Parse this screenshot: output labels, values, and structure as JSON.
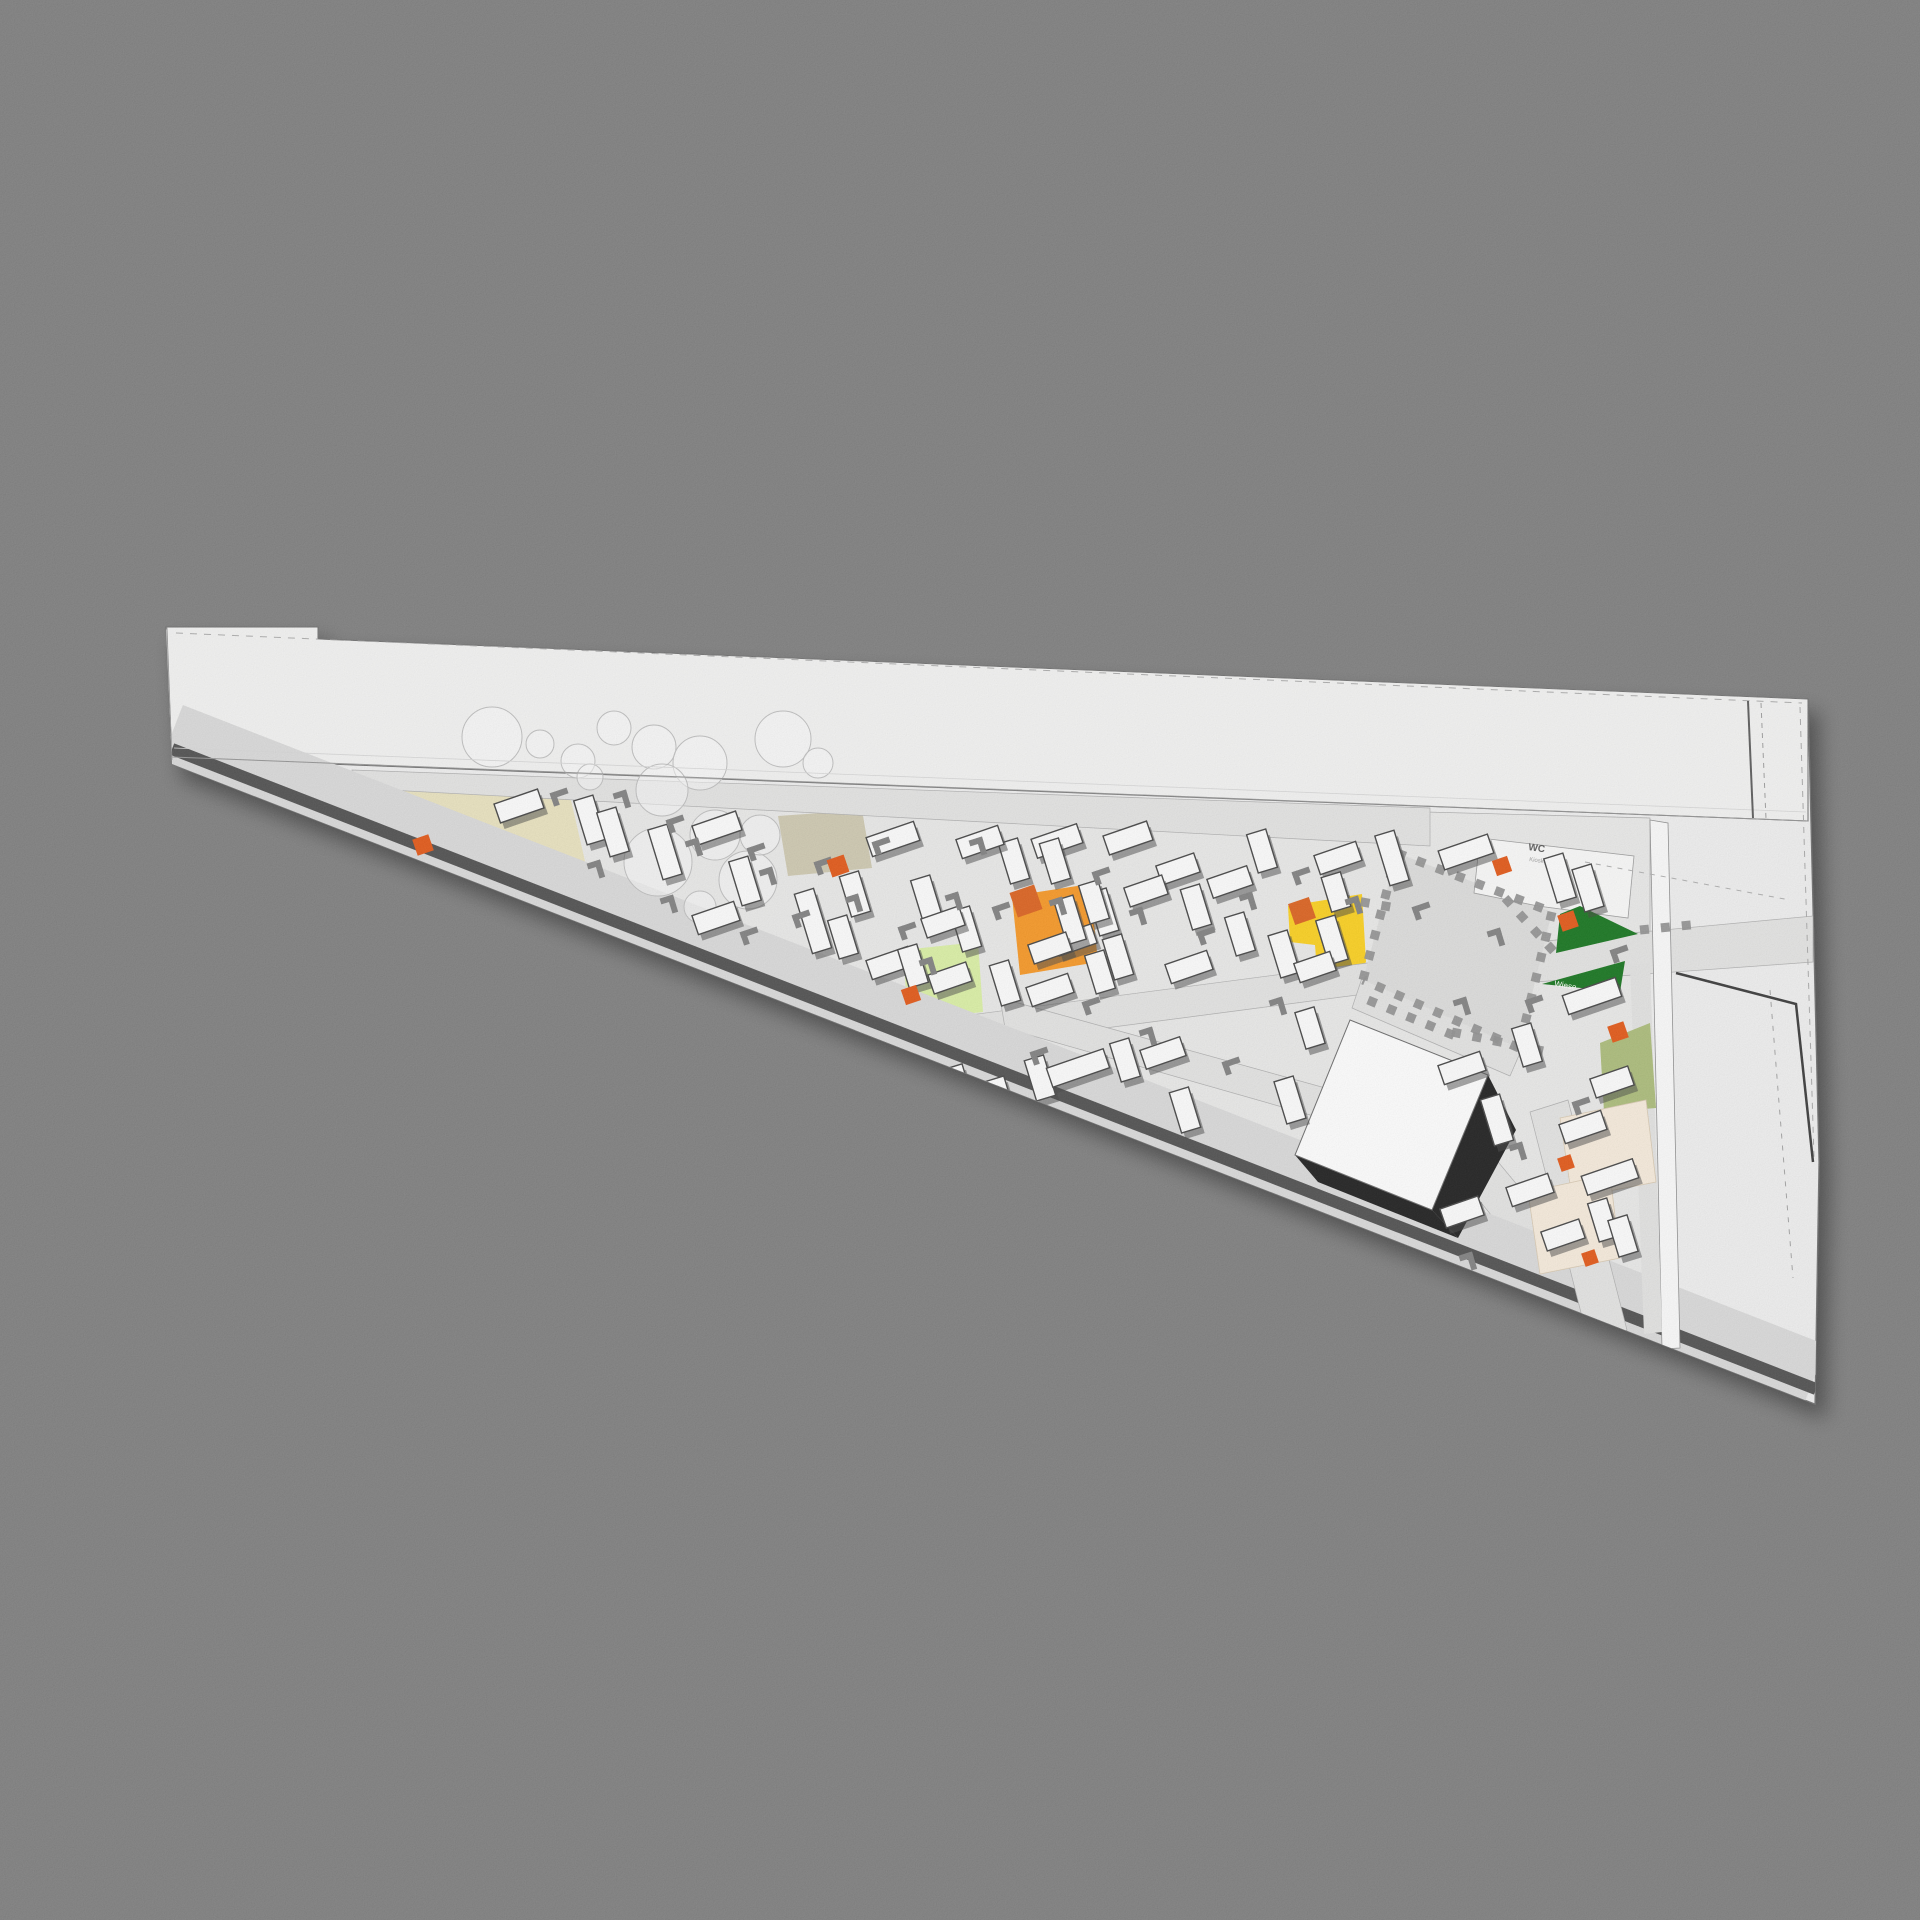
{
  "canvas": {
    "w": 1920,
    "h": 1920,
    "bg": "#7a7a7a"
  },
  "palette": {
    "floor": "#e9e9e8",
    "slab": "#efefef",
    "roof": "#f3f3f2",
    "road": "#e3e3e2",
    "band": "#d9d9d9",
    "stripe": "#4a4a4a",
    "plaza": "#dcdcdb",
    "beige": "#e9e2bd",
    "tan": "#cdc7ae",
    "orange": "#F7941E",
    "orange_dark": "#DB5B16",
    "accent": "#E25110",
    "yellow": "#FCCF14",
    "lightgreen": "#DAF0A2",
    "darkgreen": "#117014",
    "olive": "#A9BA74",
    "cream": "#F7EBDB",
    "white": "#FFFFFF",
    "room": "#fafaf9",
    "table_stroke": "#3d3d3d",
    "bench": "#7c7c7c",
    "tree_stroke": "#bdbdbd",
    "cube_shadow": "#171717",
    "cren": "#8c8c8c",
    "facade": "#fbfbfb",
    "strip2": "#e2e2e1",
    "leftface": "#dedede"
  },
  "labels": {
    "wc": "WC",
    "wc_sub": "Kiosk",
    "meadow": "Wiese"
  },
  "label_meta": {
    "wc": {
      "x": 1528,
      "y": 850,
      "size": 10,
      "rot": 8,
      "fill": "#555555",
      "bold": true
    },
    "wc_sub": {
      "x": 1529,
      "y": 861,
      "size": 6,
      "rot": 8,
      "fill": "#9a9a9a",
      "bold": false
    },
    "meadow": {
      "x": 1554,
      "y": 986,
      "size": 8,
      "rot": 10,
      "fill": "#ffffff",
      "bold": false
    }
  },
  "silhouette": [
    [
      166,
      627
    ],
    [
      318,
      627
    ],
    [
      318,
      639
    ],
    [
      1808,
      699
    ],
    [
      1819,
      1162
    ],
    [
      1815,
      1404
    ],
    [
      172,
      764
    ]
  ],
  "roof": [
    [
      166,
      627
    ],
    [
      318,
      627
    ],
    [
      318,
      639
    ],
    [
      1808,
      699
    ],
    [
      1808,
      821
    ],
    [
      172,
      758
    ]
  ],
  "floor": [
    [
      350,
      783
    ],
    [
      1650,
      818
    ],
    [
      1650,
      1302
    ]
  ],
  "zones": [
    {
      "name": "zone-beige-wedge",
      "fill": "beige",
      "pts": [
        [
          352,
          786
        ],
        [
          570,
          796
        ],
        [
          588,
          874
        ],
        [
          440,
          862
        ]
      ]
    },
    {
      "name": "zone-tan-square",
      "fill": "tan",
      "pts": [
        [
          778,
          816
        ],
        [
          862,
          810
        ],
        [
          872,
          868
        ],
        [
          788,
          876
        ]
      ]
    },
    {
      "name": "zone-orange-square",
      "fill": "orange",
      "pts": [
        [
          1012,
          896
        ],
        [
          1090,
          884
        ],
        [
          1098,
          962
        ],
        [
          1020,
          975
        ]
      ]
    },
    {
      "name": "zone-lightgreen-square",
      "fill": "lightgreen",
      "pts": [
        [
          903,
          950
        ],
        [
          978,
          942
        ],
        [
          983,
          1012
        ],
        [
          908,
          1020
        ]
      ]
    },
    {
      "name": "zone-yellow",
      "fill": "yellow",
      "pts": [
        [
          1288,
          906
        ],
        [
          1362,
          894
        ],
        [
          1366,
          962
        ],
        [
          1342,
          990
        ],
        [
          1318,
          984
        ],
        [
          1315,
          945
        ],
        [
          1290,
          942
        ]
      ]
    }
  ],
  "zones2": [
    {
      "name": "zone-left-face",
      "fill": "leftface",
      "pts": [
        [
          158,
          640
        ],
        [
          167,
          628
        ],
        [
          172,
          760
        ],
        [
          160,
          706
        ]
      ],
      "stroke": "#888888"
    },
    {
      "name": "zone-facade-strip",
      "fill": "facade",
      "pts": [
        [
          1650,
          820
        ],
        [
          1668,
          823
        ],
        [
          1680,
          1348
        ],
        [
          1662,
          1349
        ]
      ],
      "stroke": "#8a8a8a"
    },
    {
      "name": "zone-gray-strip",
      "fill": "strip2",
      "pts": [
        [
          1630,
          965
        ],
        [
          1650,
          962
        ],
        [
          1662,
          1332
        ],
        [
          1644,
          1334
        ]
      ]
    },
    {
      "name": "zone-wc-room",
      "fill": "room",
      "pts": [
        [
          1480,
          838
        ],
        [
          1634,
          856
        ],
        [
          1628,
          918
        ],
        [
          1538,
          906
        ],
        [
          1474,
          893
        ]
      ],
      "stroke": "#999999"
    },
    {
      "name": "zone-green-triangle-1",
      "fill": "darkgreen",
      "pts": [
        [
          1556,
          953
        ],
        [
          1638,
          934
        ],
        [
          1580,
          906
        ],
        [
          1560,
          914
        ]
      ]
    },
    {
      "name": "zone-green-triangle-2",
      "fill": "darkgreen",
      "pts": [
        [
          1542,
          984
        ],
        [
          1625,
          961
        ],
        [
          1620,
          992
        ]
      ]
    },
    {
      "name": "zone-olive-square",
      "fill": "olive",
      "pts": [
        [
          1600,
          1043
        ],
        [
          1650,
          1023
        ],
        [
          1656,
          1108
        ],
        [
          1604,
          1112
        ]
      ]
    },
    {
      "name": "zone-cream-area-1",
      "fill": "cream",
      "pts": [
        [
          1560,
          1118
        ],
        [
          1646,
          1100
        ],
        [
          1656,
          1182
        ],
        [
          1572,
          1198
        ]
      ],
      "stroke": "#d8c8b0"
    },
    {
      "name": "zone-cream-area-2",
      "fill": "cream",
      "pts": [
        [
          1528,
          1192
        ],
        [
          1610,
          1174
        ],
        [
          1620,
          1258
        ],
        [
          1540,
          1274
        ]
      ],
      "stroke": "#d8c8b0"
    }
  ],
  "roads": [
    {
      "name": "road-main",
      "pts": [
        [
          352,
          770
        ],
        [
          1430,
          808
        ],
        [
          1430,
          846
        ],
        [
          352,
          788
        ]
      ]
    },
    {
      "name": "road-cross-up",
      "pts": [
        [
          810,
          1036
        ],
        [
          1375,
          962
        ],
        [
          1380,
          992
        ],
        [
          816,
          1066
        ]
      ]
    },
    {
      "name": "road-cross-down",
      "pts": [
        [
          1000,
          998
        ],
        [
          1470,
          1128
        ],
        [
          1596,
          1280
        ],
        [
          1560,
          1300
        ],
        [
          1440,
          1152
        ],
        [
          1005,
          1028
        ]
      ]
    },
    {
      "name": "road-plaza-south",
      "pts": [
        [
          1362,
          978
        ],
        [
          1523,
          1046
        ],
        [
          1510,
          1076
        ],
        [
          1352,
          1008
        ]
      ]
    },
    {
      "name": "road-east",
      "pts": [
        [
          1535,
          942
        ],
        [
          1813,
          916
        ],
        [
          1813,
          962
        ],
        [
          1535,
          982
        ]
      ]
    }
  ],
  "exit_road": {
    "name": "road-exit",
    "pts": [
      [
        1530,
        1112
      ],
      [
        1568,
        1100
      ],
      [
        1627,
        1330
      ],
      [
        1590,
        1348
      ]
    ]
  },
  "band": {
    "center": [
      [
        172,
        733
      ],
      [
        1816,
        1373
      ]
    ],
    "w": 60,
    "stripe": [
      [
        172,
        749
      ],
      [
        1816,
        1389
      ]
    ],
    "stripe_w": 12
  },
  "plaza": {
    "pts": [
      [
        1397,
        853
      ],
      [
        1552,
        912
      ],
      [
        1519,
        1048
      ],
      [
        1363,
        980
      ]
    ]
  },
  "crenellation": [
    [
      [
        1397,
        853
      ],
      [
        1552,
        912
      ]
    ],
    [
      [
        1552,
        912
      ],
      [
        1519,
        1048
      ]
    ],
    [
      [
        1519,
        1048
      ],
      [
        1363,
        980
      ]
    ],
    [
      [
        1363,
        980
      ],
      [
        1397,
        853
      ]
    ],
    [
      [
        1505,
        898
      ],
      [
        1557,
        955
      ]
    ],
    [
      [
        1340,
        898
      ],
      [
        1396,
        908
      ]
    ],
    [
      [
        1368,
        1000
      ],
      [
        1460,
        1038
      ]
    ],
    [
      [
        1452,
        1032
      ],
      [
        1548,
        1052
      ]
    ],
    [
      [
        1640,
        930
      ],
      [
        1700,
        924
      ]
    ]
  ],
  "cube": {
    "pts": [
      [
        1350,
        1020
      ],
      [
        1488,
        1075
      ],
      [
        1432,
        1210
      ],
      [
        1295,
        1155
      ]
    ],
    "shadow": [
      [
        [
          1488,
          1075
        ],
        [
          1516,
          1130
        ],
        [
          1458,
          1238
        ],
        [
          1432,
          1210
        ]
      ],
      [
        [
          1295,
          1155
        ],
        [
          1432,
          1210
        ],
        [
          1458,
          1238
        ],
        [
          1318,
          1182
        ]
      ]
    ]
  },
  "trees": [
    [
      492,
      737,
      30
    ],
    [
      540,
      744,
      14
    ],
    [
      578,
      761,
      17
    ],
    [
      614,
      728,
      17
    ],
    [
      590,
      777,
      13
    ],
    [
      654,
      747,
      22
    ],
    [
      700,
      763,
      27
    ],
    [
      783,
      739,
      28
    ],
    [
      818,
      763,
      15
    ],
    [
      662,
      790,
      26
    ],
    [
      658,
      862,
      34
    ],
    [
      715,
      835,
      25
    ],
    [
      748,
      880,
      29
    ],
    [
      760,
      835,
      20
    ],
    [
      700,
      907,
      16
    ]
  ],
  "tables": [
    [
      519,
      806,
      -19,
      46
    ],
    [
      590,
      820,
      73,
      46
    ],
    [
      613,
      832,
      73,
      46
    ],
    [
      665,
      852,
      73,
      52
    ],
    [
      717,
      828,
      -19,
      46
    ],
    [
      745,
      881,
      73,
      46
    ],
    [
      716,
      918,
      -19,
      44
    ],
    [
      893,
      839,
      -19,
      50
    ],
    [
      855,
      894,
      73,
      42
    ],
    [
      813,
      921,
      73,
      62
    ],
    [
      843,
      937,
      73,
      40
    ],
    [
      890,
      963,
      -19,
      44
    ],
    [
      926,
      897,
      73,
      40
    ],
    [
      966,
      929,
      73,
      42
    ],
    [
      1014,
      861,
      73,
      42
    ],
    [
      1057,
      841,
      -19,
      48
    ],
    [
      980,
      842,
      -19,
      44
    ],
    [
      950,
      978,
      -19,
      40
    ],
    [
      1005,
      983,
      73,
      42
    ],
    [
      1050,
      990,
      -19,
      44
    ],
    [
      1100,
      972,
      73,
      40
    ],
    [
      1055,
      861,
      73,
      42
    ],
    [
      1128,
      838,
      -19,
      46
    ],
    [
      1178,
      869,
      -19,
      40
    ],
    [
      1103,
      912,
      73,
      44
    ],
    [
      1146,
      891,
      -19,
      40
    ],
    [
      1196,
      907,
      73,
      42
    ],
    [
      1230,
      882,
      -19,
      42
    ],
    [
      1118,
      957,
      73,
      42
    ],
    [
      1189,
      967,
      -19,
      44
    ],
    [
      1240,
      934,
      73,
      40
    ],
    [
      1075,
      940,
      -19,
      40
    ],
    [
      1262,
      851,
      73,
      40
    ],
    [
      1338,
      858,
      -19,
      44
    ],
    [
      1284,
      954,
      73,
      44
    ],
    [
      1392,
      858,
      73,
      52
    ],
    [
      1336,
      892,
      73,
      36
    ],
    [
      1466,
      852,
      -19,
      52
    ],
    [
      1560,
      878,
      73,
      46
    ],
    [
      1588,
      888,
      73,
      44
    ],
    [
      1592,
      996,
      -19,
      56
    ],
    [
      1040,
      1078,
      73,
      42
    ],
    [
      1078,
      1068,
      -19,
      60
    ],
    [
      1125,
      1060,
      73,
      40
    ],
    [
      1163,
      1053,
      -19,
      42
    ],
    [
      1185,
      1110,
      73,
      42
    ],
    [
      958,
      1085,
      73,
      38
    ],
    [
      1000,
      1098,
      73,
      40
    ],
    [
      1290,
      1100,
      73,
      44
    ],
    [
      1310,
      1028,
      73,
      38
    ],
    [
      1497,
      1120,
      73,
      48
    ],
    [
      1462,
      1068,
      -19,
      44
    ],
    [
      1527,
      1045,
      73,
      40
    ],
    [
      1530,
      1190,
      -19,
      44
    ],
    [
      1583,
      1127,
      -19,
      44
    ],
    [
      1610,
      1177,
      -19,
      54
    ],
    [
      1603,
      1220,
      73,
      40
    ],
    [
      1563,
      1235,
      -19,
      40
    ],
    [
      1623,
      1236,
      73,
      38
    ],
    [
      1462,
      1212,
      -19,
      40
    ],
    [
      1612,
      1082,
      -19,
      40
    ],
    [
      1094,
      902,
      73,
      40
    ],
    [
      913,
      966,
      73,
      40
    ],
    [
      943,
      922,
      -19,
      40
    ],
    [
      1070,
      920,
      73,
      46
    ],
    [
      1050,
      948,
      -19,
      40
    ],
    [
      1332,
      940,
      73,
      46
    ],
    [
      1315,
      967,
      -19,
      38
    ]
  ],
  "benches": [
    [
      560,
      793,
      -19
    ],
    [
      600,
      870,
      73
    ],
    [
      676,
      820,
      -19
    ],
    [
      698,
      848,
      73
    ],
    [
      757,
      848,
      -19
    ],
    [
      673,
      905,
      73
    ],
    [
      750,
      932,
      -19
    ],
    [
      772,
      877,
      73
    ],
    [
      824,
      862,
      -19
    ],
    [
      858,
      904,
      73
    ],
    [
      908,
      927,
      -19
    ],
    [
      958,
      902,
      73
    ],
    [
      1002,
      907,
      -19
    ],
    [
      932,
      967,
      73
    ],
    [
      1040,
      1052,
      -19
    ],
    [
      1062,
      907,
      73
    ],
    [
      1102,
      872,
      -19
    ],
    [
      1142,
      917,
      73
    ],
    [
      1207,
      932,
      -19
    ],
    [
      1252,
      902,
      73
    ],
    [
      1302,
      872,
      -19
    ],
    [
      1358,
      906,
      73
    ],
    [
      1092,
      1002,
      -19
    ],
    [
      1152,
      1037,
      73
    ],
    [
      1232,
      1062,
      -19
    ],
    [
      1282,
      1007,
      73
    ],
    [
      1422,
      907,
      -19
    ],
    [
      1466,
      1007,
      73
    ],
    [
      1535,
      1000,
      -19
    ],
    [
      1522,
      1152,
      73
    ],
    [
      1582,
      1102,
      -19
    ],
    [
      1472,
      1262,
      73
    ],
    [
      882,
      842,
      -19
    ],
    [
      982,
      847,
      73
    ],
    [
      802,
      915,
      -19
    ],
    [
      626,
      800,
      73
    ],
    [
      1620,
      950,
      -19
    ],
    [
      1500,
      938,
      73
    ]
  ],
  "accents": [
    [
      423,
      845,
      -19,
      17,
      "accent"
    ],
    [
      838,
      866,
      -19,
      18,
      "accent"
    ],
    [
      911,
      995,
      -19,
      16,
      "accent"
    ],
    [
      1568,
      921,
      -19,
      17,
      "accent"
    ],
    [
      1502,
      866,
      -19,
      16,
      "accent"
    ],
    [
      1618,
      1032,
      -19,
      17,
      "accent"
    ],
    [
      1566,
      1163,
      -19,
      14,
      "accent"
    ],
    [
      1590,
      1258,
      -19,
      14,
      "accent"
    ],
    [
      1026,
      901,
      -19,
      26,
      "orange_dark"
    ],
    [
      1302,
      911,
      -19,
      22,
      "orange_dark"
    ]
  ],
  "lines": [
    {
      "name": "roof-top-dashed",
      "pts": [
        [
          176,
          633
        ],
        [
          1802,
          703
        ]
      ],
      "c": "#a9a9a9",
      "w": 1,
      "dash": "7 7"
    },
    {
      "name": "roof-bottom-line",
      "pts": [
        [
          172,
          757
        ],
        [
          1808,
          821
        ]
      ],
      "c": "#8f8f8f",
      "w": 1
    },
    {
      "name": "roof-bottom-hairline",
      "pts": [
        [
          174,
          748
        ],
        [
          1806,
          812
        ]
      ],
      "c": "#d6d6d6",
      "w": 0.8
    },
    {
      "name": "right-wall-line",
      "pts": [
        [
          1748,
          701
        ],
        [
          1753,
          818
        ]
      ],
      "c": "#555555",
      "w": 2
    },
    {
      "name": "right-wall-dashed",
      "pts": [
        [
          1761,
          703
        ],
        [
          1766,
          819
        ]
      ],
      "c": "#999999",
      "w": 1,
      "dash": "5 5"
    },
    {
      "name": "right-edge-dashed",
      "pts": [
        [
          1800,
          707
        ],
        [
          1814,
          1158
        ]
      ],
      "c": "#a5a5a5",
      "w": 1,
      "dash": "6 6"
    },
    {
      "name": "site-boundary-dark",
      "pts": [
        [
          1676,
          973
        ],
        [
          1796,
          1004
        ],
        [
          1813,
          1162
        ]
      ],
      "c": "#333333",
      "w": 2.5
    },
    {
      "name": "boundary-dashed",
      "pts": [
        [
          1770,
          990
        ],
        [
          1793,
          1278
        ]
      ],
      "c": "#9f9f9f",
      "w": 1,
      "dash": "5 7"
    },
    {
      "name": "mid-right-dashed",
      "pts": [
        [
          1585,
          862
        ],
        [
          1790,
          900
        ]
      ],
      "c": "#ababab",
      "w": 1,
      "dash": "5 6"
    }
  ]
}
